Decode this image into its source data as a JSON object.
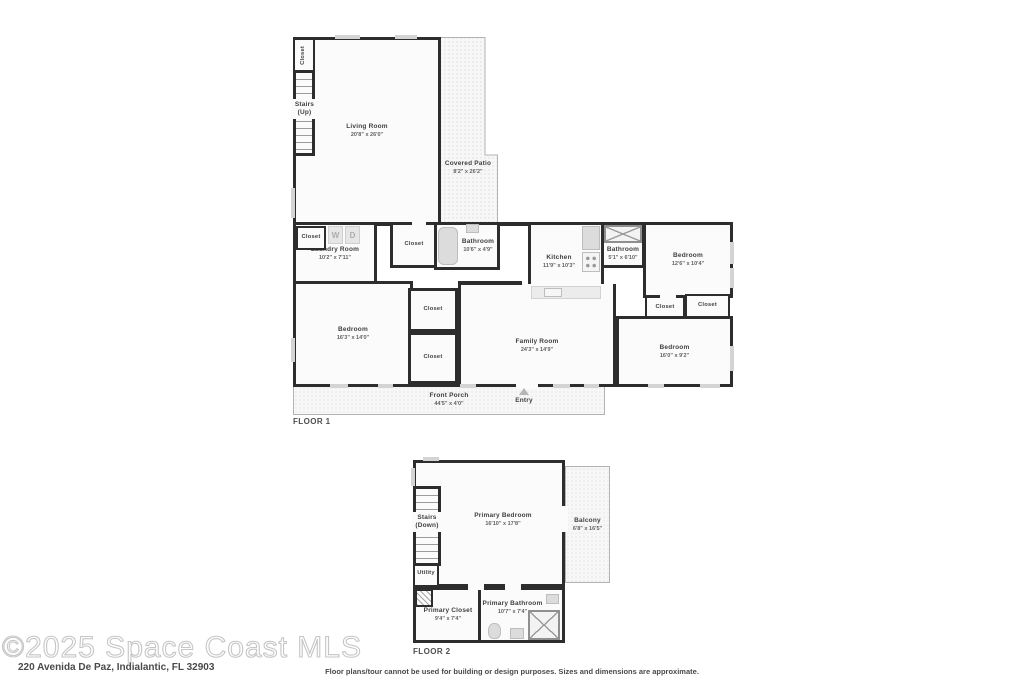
{
  "meta": {
    "watermark": "©2025 Space Coast MLS",
    "address": "220 Avenida De Paz, Indialantic, FL 32903",
    "disclaimer": "Floor plans/tour cannot be used for building or design purposes. Sizes and dimensions are approximate."
  },
  "floor1": {
    "label": "FLOOR 1",
    "wd": {
      "w": "W",
      "d": "D"
    },
    "rooms": {
      "closet_tl": {
        "name": "Closet"
      },
      "stairs": {
        "name": "Stairs",
        "sub": "(Up)"
      },
      "living": {
        "name": "Living Room",
        "dims": "20'8\" x 26'0\""
      },
      "patio": {
        "name": "Covered Patio",
        "dims": "8'2\" x 26'2\""
      },
      "laundry": {
        "name": "Laundry Room",
        "dims": "10'2\" x 7'11\""
      },
      "laundry_closet": {
        "name": "Closet"
      },
      "closet_hall": {
        "name": "Closet"
      },
      "bath1": {
        "name": "Bathroom",
        "dims": "10'6\" x 4'9\""
      },
      "kitchen": {
        "name": "Kitchen",
        "dims": "11'9\" x 10'3\""
      },
      "bath2": {
        "name": "Bathroom",
        "dims": "5'1\" x 6'10\""
      },
      "bed_tr": {
        "name": "Bedroom",
        "dims": "12'6\" x 10'4\""
      },
      "bed_bl": {
        "name": "Bedroom",
        "dims": "16'3\" x 14'0\""
      },
      "closet_m1": {
        "name": "Closet"
      },
      "closet_m2": {
        "name": "Closet"
      },
      "family": {
        "name": "Family Room",
        "dims": "24'3\" x 14'9\""
      },
      "closet_r1": {
        "name": "Closet"
      },
      "closet_r2": {
        "name": "Closet"
      },
      "bed_br": {
        "name": "Bedroom",
        "dims": "16'0\" x 9'2\""
      },
      "porch": {
        "name": "Front Porch",
        "dims": "44'5\" x 4'0\""
      },
      "entry": {
        "name": "Entry"
      }
    }
  },
  "floor2": {
    "label": "FLOOR 2",
    "rooms": {
      "stairs": {
        "name": "Stairs",
        "sub": "(Down)"
      },
      "primary_bedroom": {
        "name": "Primary Bedroom",
        "dims": "16'10\" x 17'8\""
      },
      "balcony": {
        "name": "Balcony",
        "dims": "6'8\" x 16'5\""
      },
      "utility": {
        "name": "Utility"
      },
      "primary_closet": {
        "name": "Primary Closet",
        "dims": "9'4\" x 7'4\""
      },
      "primary_bath": {
        "name": "Primary Bathroom",
        "dims": "10'7\" x 7'4\""
      }
    }
  }
}
